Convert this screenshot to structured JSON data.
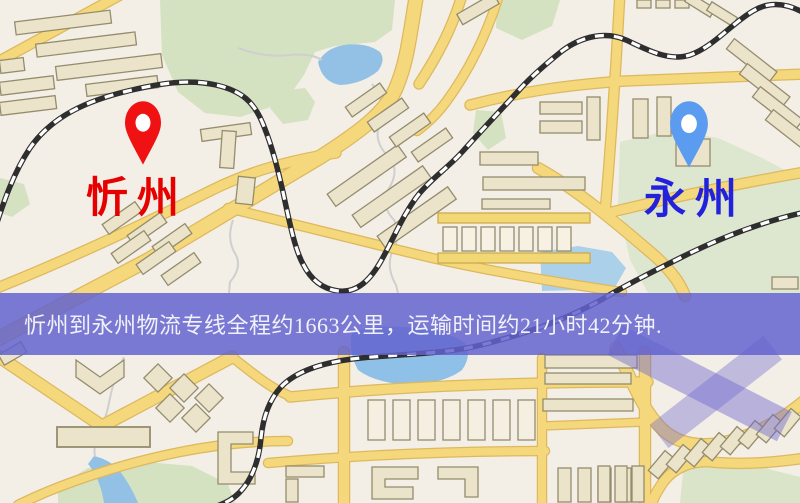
{
  "map": {
    "origin": {
      "label": "忻州",
      "pin": "red-location-pin"
    },
    "destination": {
      "label": "永州",
      "pin": "blue-location-pin"
    }
  },
  "banner": {
    "text": "忻州到永州物流专线全程约1663公里，运输时间约21小时42分钟.",
    "distance_km": "1663",
    "duration_hours": "21",
    "duration_minutes": "42"
  },
  "colors": {
    "origin-label": "#e60000",
    "destination-label": "#2222dd",
    "origin-pin": "#f01212",
    "destination-pin": "#5b9bf0",
    "banner-bg": "#6363cf",
    "banner-text": "#f1f1fa"
  }
}
